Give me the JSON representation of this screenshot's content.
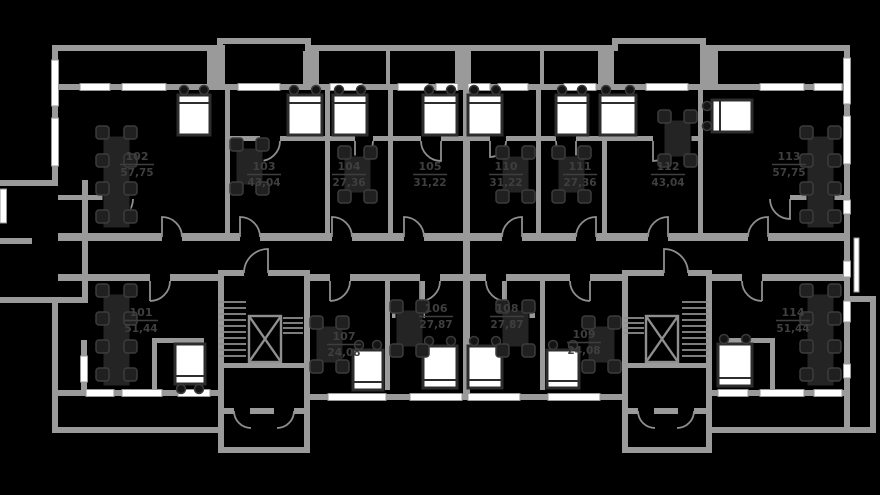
{
  "apartments": [
    {
      "number": "101",
      "area": "51,44"
    },
    {
      "number": "102",
      "area": "57,75"
    },
    {
      "number": "103",
      "area": "43,04"
    },
    {
      "number": "104",
      "area": "27,36"
    },
    {
      "number": "105",
      "area": "31,22"
    },
    {
      "number": "106",
      "area": "27,87"
    },
    {
      "number": "107",
      "area": "24,08"
    },
    {
      "number": "108",
      "area": "27,87"
    },
    {
      "number": "109",
      "area": "24,08"
    },
    {
      "number": "110",
      "area": "31,22"
    },
    {
      "number": "111",
      "area": "27,36"
    },
    {
      "number": "112",
      "area": "43,04"
    },
    {
      "number": "113",
      "area": "57,75"
    },
    {
      "number": "114",
      "area": "51,44"
    }
  ],
  "colors": {
    "background": "#000000",
    "walls": "#9a9a9a",
    "windows": "#ffffff",
    "furniture": "#242424",
    "label_text": "#3f3f3f"
  }
}
